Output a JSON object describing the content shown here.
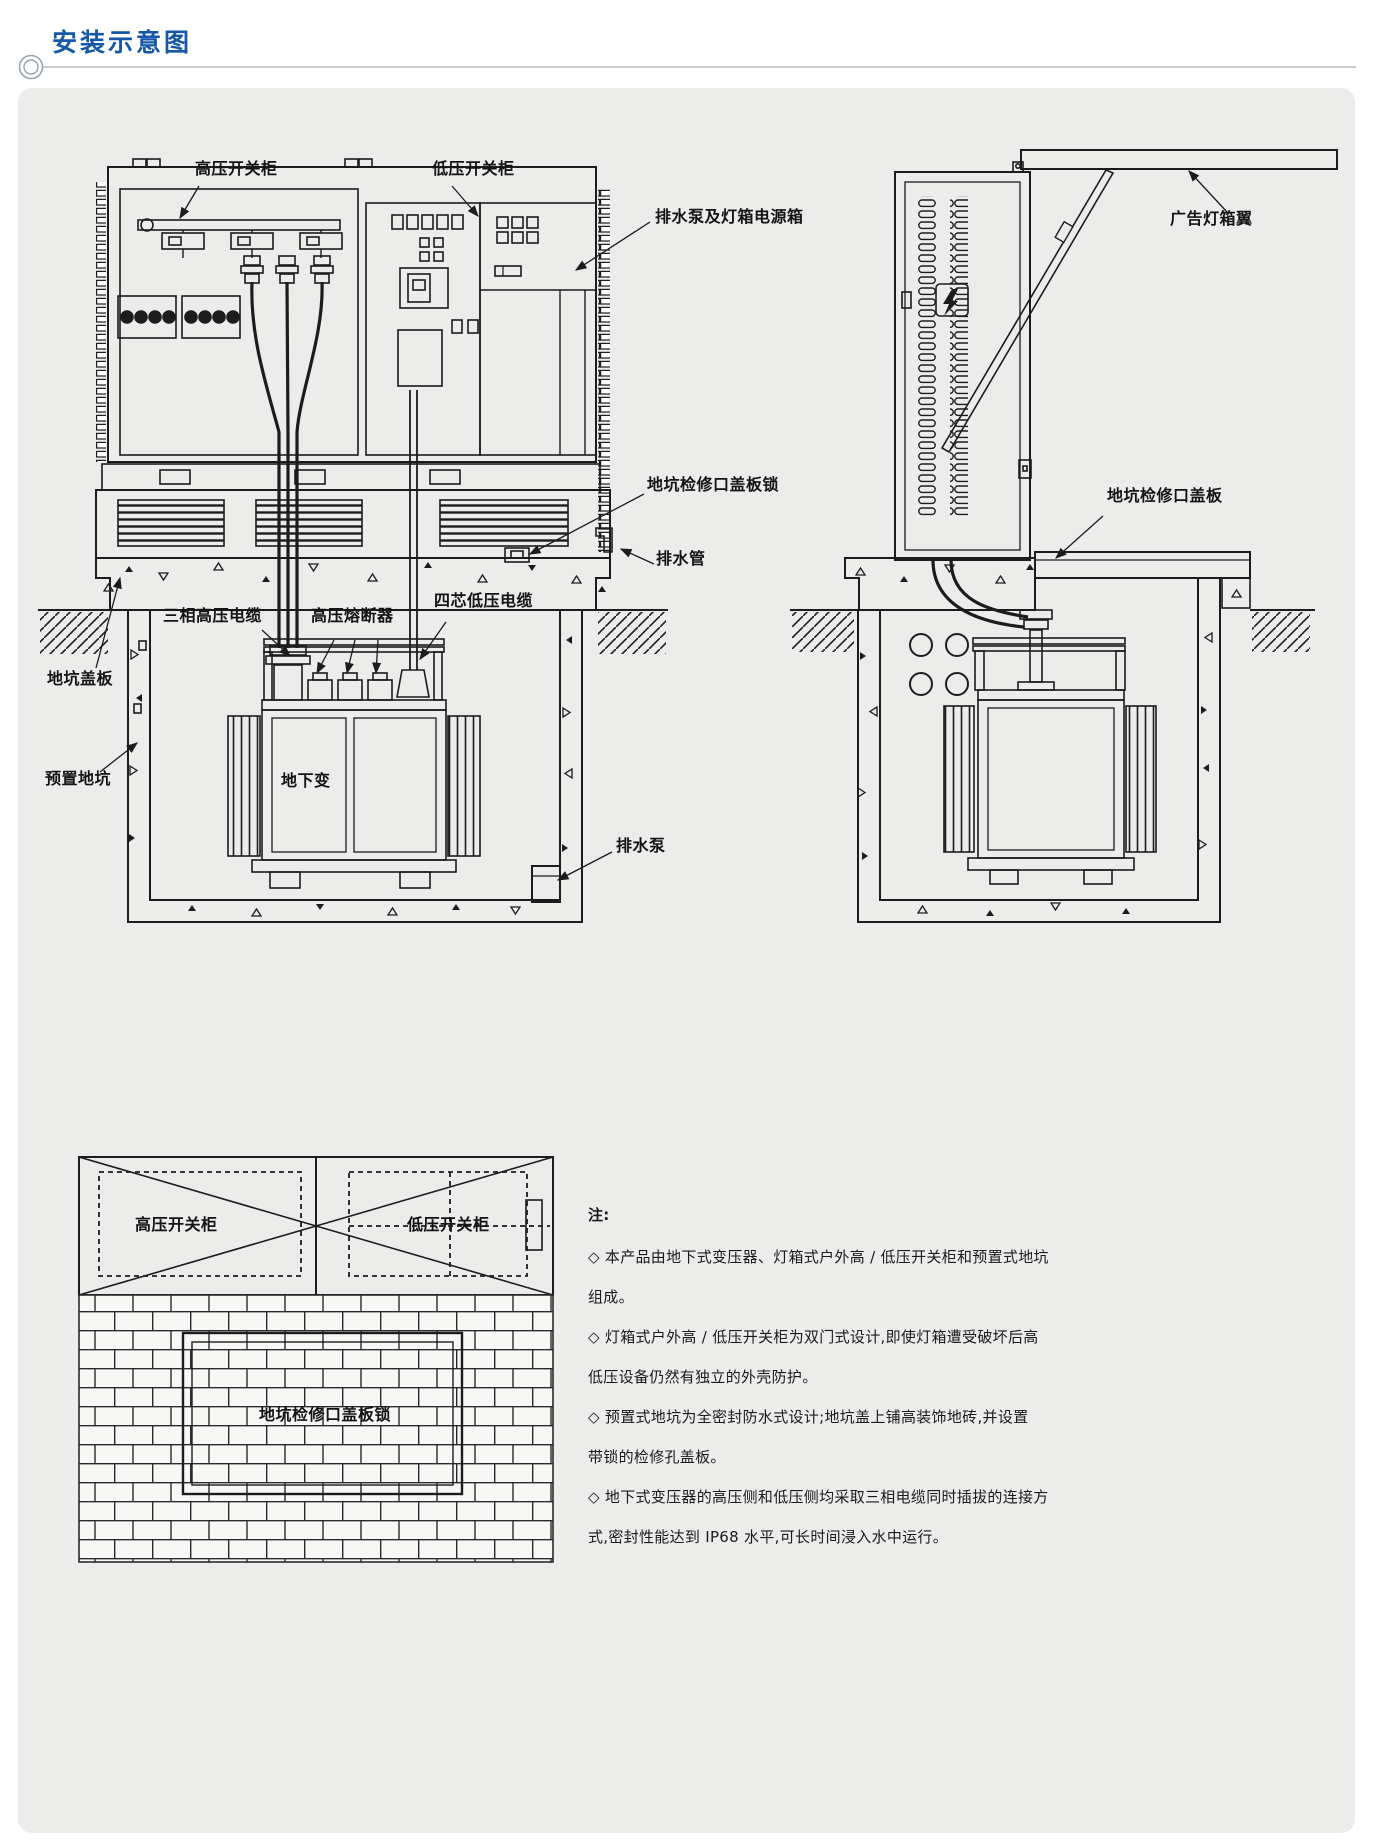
{
  "header": {
    "title": "安装示意图"
  },
  "front_view": {
    "labels": {
      "hv_cabinet": "高压开关柜",
      "lv_cabinet": "低压开关柜",
      "pump_power_box": "排水泵及灯箱电源箱",
      "pit_hatch_lock": "地坑检修口盖板锁",
      "drain_pipe": "排水管",
      "hv_cable": "三相高压电缆",
      "hv_fuse": "高压熔断器",
      "lv_cable": "四芯低压电缆",
      "pit_cover": "地坑盖板",
      "precast_pit": "预置地坑",
      "transformer": "地下变",
      "drain_pump": "排水泵"
    }
  },
  "side_view": {
    "labels": {
      "ad_wing": "广告灯箱翼",
      "pit_hatch_cover": "地坑检修口盖板"
    }
  },
  "top_view": {
    "labels": {
      "hv_cabinet": "高压开关柜",
      "lv_cabinet": "低压开关柜",
      "pit_hatch_lock": "地坑检修口盖板锁"
    }
  },
  "notes": {
    "heading": "注:",
    "lines": [
      "◇ 本产品由地下式变压器、灯箱式户外高 / 低压开关柜和预置式地坑",
      "组成。",
      "◇ 灯箱式户外高 / 低压开关柜为双门式设计,即使灯箱遭受破坏后高",
      "低压设备仍然有独立的外壳防护。",
      "◇ 预置式地坑为全密封防水式设计;地坑盖上铺高装饰地砖,并设置",
      "带锁的检修孔盖板。",
      "◇ 地下式变压器的高压侧和低压侧均采取三相电缆同时插拔的连接方",
      "式,密封性能达到 IP68 水平,可长时间浸入水中运行。"
    ]
  },
  "colors": {
    "accent_blue": "#1658a8",
    "line": "#1c1c1c",
    "panel_bg": "#ececeb"
  }
}
